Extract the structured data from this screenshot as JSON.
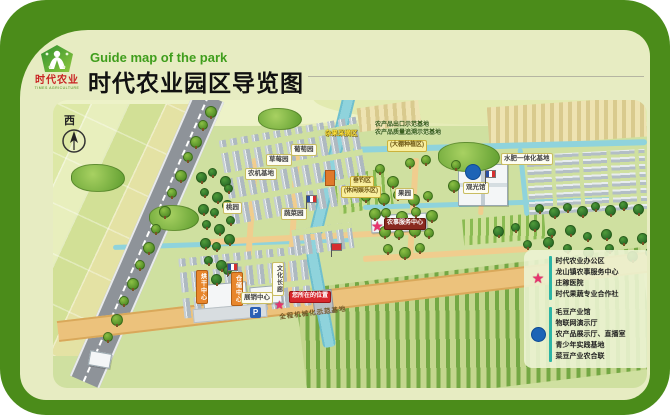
{
  "header": {
    "subtitle_en": "Guide map of the park",
    "title_cn": "时代农业园区导览图",
    "logo": {
      "name_cn": "时代农业",
      "name_en": "TIMES AGRICULTURE"
    }
  },
  "map": {
    "compass_label": "西",
    "parking_label": "P",
    "road_banner": "全程机械化示范基地",
    "labels": [
      {
        "t": "杂果采摘区",
        "x": 272,
        "y": 30,
        "s": "ytext"
      },
      {
        "t": "葡萄园",
        "x": 238,
        "y": 44,
        "s": "wbox"
      },
      {
        "t": "草莓园",
        "x": 213,
        "y": 54,
        "s": "wbox"
      },
      {
        "t": "农机基地",
        "x": 192,
        "y": 68,
        "s": "wbox"
      },
      {
        "t": "桃园",
        "x": 170,
        "y": 102,
        "s": "wbox"
      },
      {
        "t": "蔬菜园",
        "x": 228,
        "y": 108,
        "s": "wbox"
      },
      {
        "t": "垂钓区",
        "x": 297,
        "y": 76,
        "s": "ybox"
      },
      {
        "t": "(休闲娱乐区)",
        "x": 288,
        "y": 86,
        "s": "ybox"
      },
      {
        "t": "农产品出口示范基地",
        "x": 322,
        "y": 22,
        "s": "dtext"
      },
      {
        "t": "农产品质量追溯示范基地",
        "x": 322,
        "y": 30,
        "s": "dtext"
      },
      {
        "t": "(大棚种植区)",
        "x": 334,
        "y": 40,
        "s": "ybox"
      },
      {
        "t": "水肥一体化基地",
        "x": 448,
        "y": 53,
        "s": "wbox"
      },
      {
        "t": "果园",
        "x": 342,
        "y": 88,
        "s": "wbox"
      },
      {
        "t": "观光馆",
        "x": 410,
        "y": 82,
        "s": "wbox"
      },
      {
        "t": "农事服务中心",
        "x": 331,
        "y": 118,
        "s": "dbox"
      },
      {
        "t": "文化长廊",
        "x": 219,
        "y": 162,
        "s": "vwhite"
      },
      {
        "t": "烘干中心",
        "x": 143,
        "y": 170,
        "s": "vorange"
      },
      {
        "t": "仓储中心",
        "x": 178,
        "y": 172,
        "s": "vorange"
      },
      {
        "t": "展销中心",
        "x": 188,
        "y": 192,
        "s": "wbox"
      },
      {
        "t": "您所在的位置",
        "x": 236,
        "y": 191,
        "s": "rbox"
      },
      {
        "t": "全程机械化示范基地",
        "x": 226,
        "y": 214,
        "s": "road",
        "r": -7
      }
    ],
    "trees": [
      [
        152,
        6,
        0
      ],
      [
        145,
        20,
        1
      ],
      [
        137,
        36,
        0
      ],
      [
        130,
        52,
        1
      ],
      [
        122,
        70,
        0
      ],
      [
        114,
        88,
        1
      ],
      [
        106,
        106,
        0
      ],
      [
        98,
        124,
        1
      ],
      [
        90,
        142,
        0
      ],
      [
        82,
        160,
        1
      ],
      [
        74,
        178,
        0
      ],
      [
        66,
        196,
        1
      ],
      [
        58,
        214,
        0
      ],
      [
        50,
        232,
        1
      ],
      [
        143,
        72,
        2
      ],
      [
        155,
        68,
        3
      ],
      [
        167,
        76,
        2
      ],
      [
        147,
        88,
        3
      ],
      [
        159,
        92,
        2
      ],
      [
        171,
        84,
        3
      ],
      [
        145,
        104,
        2
      ],
      [
        157,
        108,
        3
      ],
      [
        169,
        100,
        2
      ],
      [
        149,
        120,
        3
      ],
      [
        161,
        124,
        2
      ],
      [
        173,
        116,
        3
      ],
      [
        147,
        138,
        2
      ],
      [
        159,
        142,
        3
      ],
      [
        171,
        134,
        2
      ],
      [
        151,
        156,
        3
      ],
      [
        163,
        160,
        2
      ],
      [
        146,
        170,
        3
      ],
      [
        158,
        174,
        2
      ],
      [
        170,
        166,
        3
      ],
      [
        322,
        64,
        1
      ],
      [
        334,
        76,
        0
      ],
      [
        398,
        60,
        1
      ],
      [
        395,
        80,
        0
      ],
      [
        308,
        92,
        1
      ],
      [
        316,
        108,
        0
      ],
      [
        352,
        58,
        1
      ],
      [
        368,
        55,
        1
      ],
      [
        482,
        104,
        3
      ],
      [
        496,
        107,
        2
      ],
      [
        510,
        103,
        3
      ],
      [
        524,
        106,
        2
      ],
      [
        538,
        102,
        3
      ],
      [
        552,
        105,
        2
      ],
      [
        566,
        101,
        3
      ],
      [
        580,
        104,
        2
      ],
      [
        325,
        93,
        0
      ],
      [
        340,
        90,
        1
      ],
      [
        355,
        94,
        0
      ],
      [
        370,
        91,
        1
      ],
      [
        328,
        108,
        1
      ],
      [
        343,
        111,
        0
      ],
      [
        358,
        107,
        1
      ],
      [
        373,
        110,
        0
      ],
      [
        326,
        126,
        0
      ],
      [
        341,
        129,
        1
      ],
      [
        356,
        125,
        0
      ],
      [
        371,
        128,
        1
      ],
      [
        330,
        144,
        1
      ],
      [
        346,
        147,
        0
      ],
      [
        362,
        143,
        1
      ],
      [
        440,
        126,
        2
      ],
      [
        458,
        123,
        3
      ],
      [
        476,
        120,
        2
      ],
      [
        494,
        128,
        3
      ],
      [
        512,
        125,
        2
      ],
      [
        530,
        132,
        3
      ],
      [
        548,
        129,
        2
      ],
      [
        566,
        136,
        3
      ],
      [
        584,
        133,
        2
      ],
      [
        470,
        140,
        3
      ],
      [
        490,
        137,
        2
      ],
      [
        510,
        144,
        3
      ],
      [
        530,
        147,
        2
      ],
      [
        552,
        144,
        3
      ],
      [
        574,
        151,
        2
      ],
      [
        592,
        148,
        3
      ]
    ],
    "bushes": [
      [
        18,
        64,
        52,
        26
      ],
      [
        96,
        105,
        48,
        24
      ],
      [
        385,
        42,
        60,
        28
      ],
      [
        205,
        8,
        42,
        20
      ]
    ],
    "flags": [
      [
        253,
        95,
        0
      ],
      [
        174,
        163,
        0
      ],
      [
        432,
        70,
        0
      ],
      [
        278,
        143,
        1
      ]
    ]
  },
  "legend": {
    "star": {
      "color": "#e8336e",
      "items": [
        "时代农业办公区",
        "龙山镇农事服务中心",
        "庄稼医院",
        "时代果蔬专业合作社"
      ]
    },
    "dot": {
      "color": "#1d64b6",
      "items": [
        "毛豆产业馆",
        "物联网演示厅",
        "农产品展示厅、直播室",
        "青少年实践基地",
        "菜豆产业农合联"
      ]
    }
  },
  "colors": {
    "frame_green": "#4b8c1a",
    "card_bg": "#e7ecc2",
    "map_bg": "#cfe0a0",
    "river": "#8fd3dc",
    "road_gray": "#8e9399",
    "road_tan": "#ecc27c",
    "star_pink": "#e8336e",
    "dot_blue": "#1d64b6",
    "legend_bar_teal": "#2cb4a4",
    "subtitle_green": "#3f9e1c",
    "logo_red": "#c92222"
  }
}
